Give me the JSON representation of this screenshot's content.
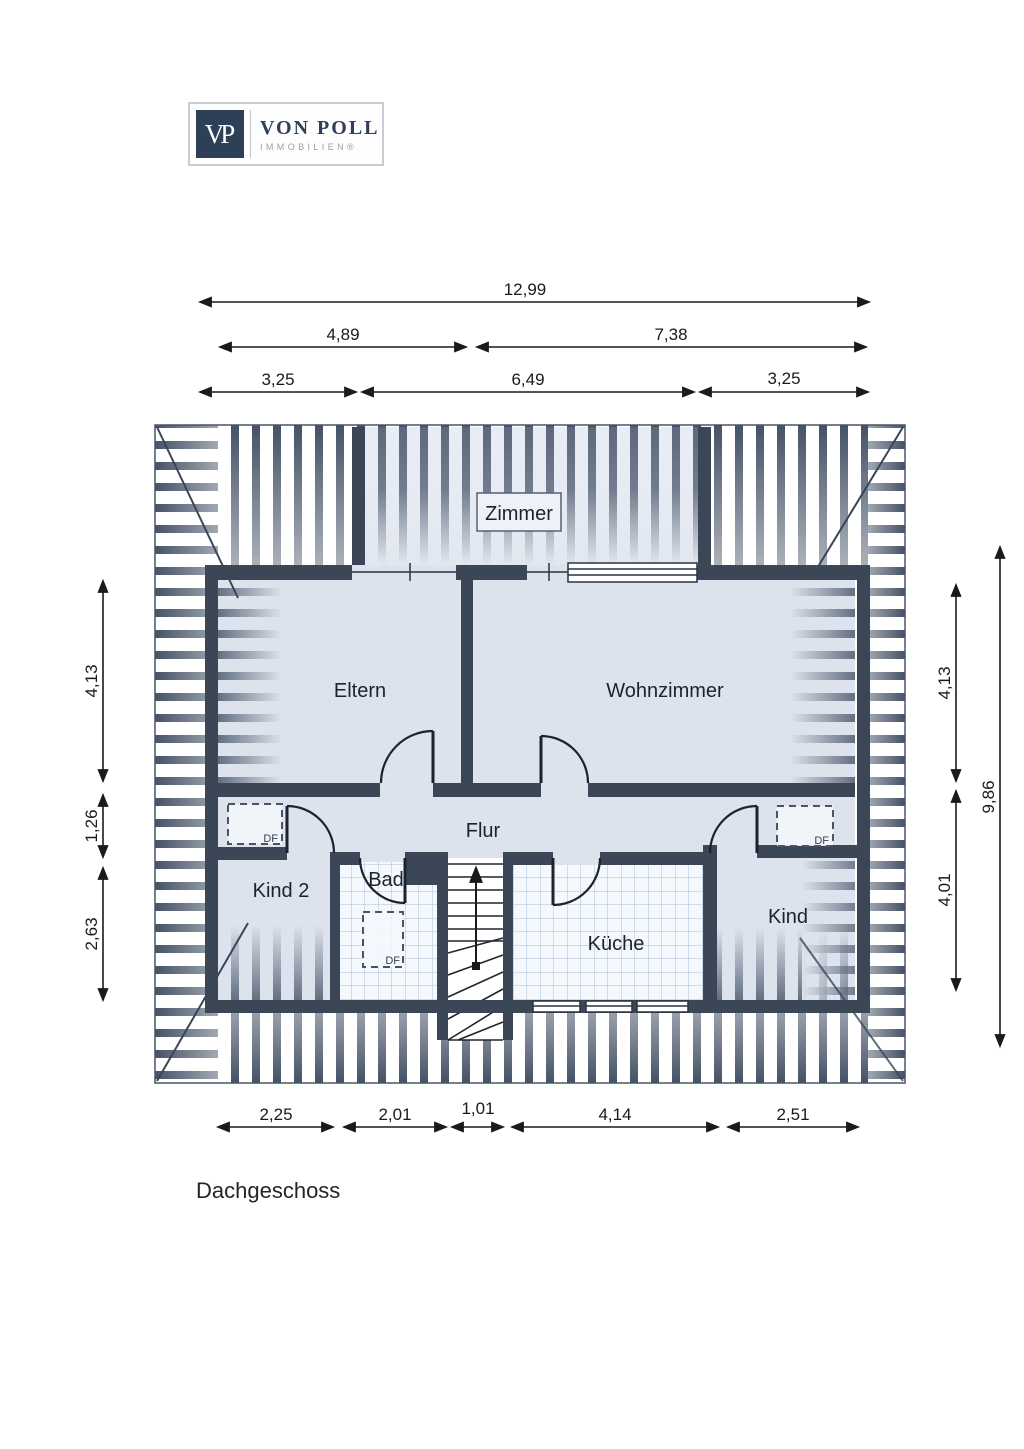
{
  "logo": {
    "monogram": "VP",
    "name": "VON POLL",
    "subtitle": "IMMOBILIEN®"
  },
  "floor_plan": {
    "title": "Dachgeschoss",
    "rooms": {
      "zimmer": "Zimmer",
      "eltern": "Eltern",
      "wohnzimmer": "Wohnzimmer",
      "flur": "Flur",
      "kind2": "Kind 2",
      "bad": "Bad",
      "kueche": "Küche",
      "kind": "Kind"
    },
    "roof_window_label": "DF"
  },
  "dimensions": {
    "top_row1": [
      "12,99"
    ],
    "top_row2": [
      "4,89",
      "7,38"
    ],
    "top_row3": [
      "3,25",
      "6,49",
      "3,25"
    ],
    "left": [
      "4,13",
      "1,26",
      "2,63"
    ],
    "right_inner": [
      "4,13",
      "4,01"
    ],
    "right_outer": [
      "9,86"
    ],
    "bottom": [
      "2,25",
      "2,01",
      "1,01",
      "4,14",
      "2,51"
    ]
  },
  "colors": {
    "wall": "#3b4757",
    "stripe": "#455266",
    "room_fill": "#dde3ed",
    "tile_bg": "#f5f8fc",
    "tile_line": "#a9c0dc",
    "ink": "#1a1a1a",
    "brand_navy": "#2e4058",
    "brand_gray": "#999fa8"
  }
}
